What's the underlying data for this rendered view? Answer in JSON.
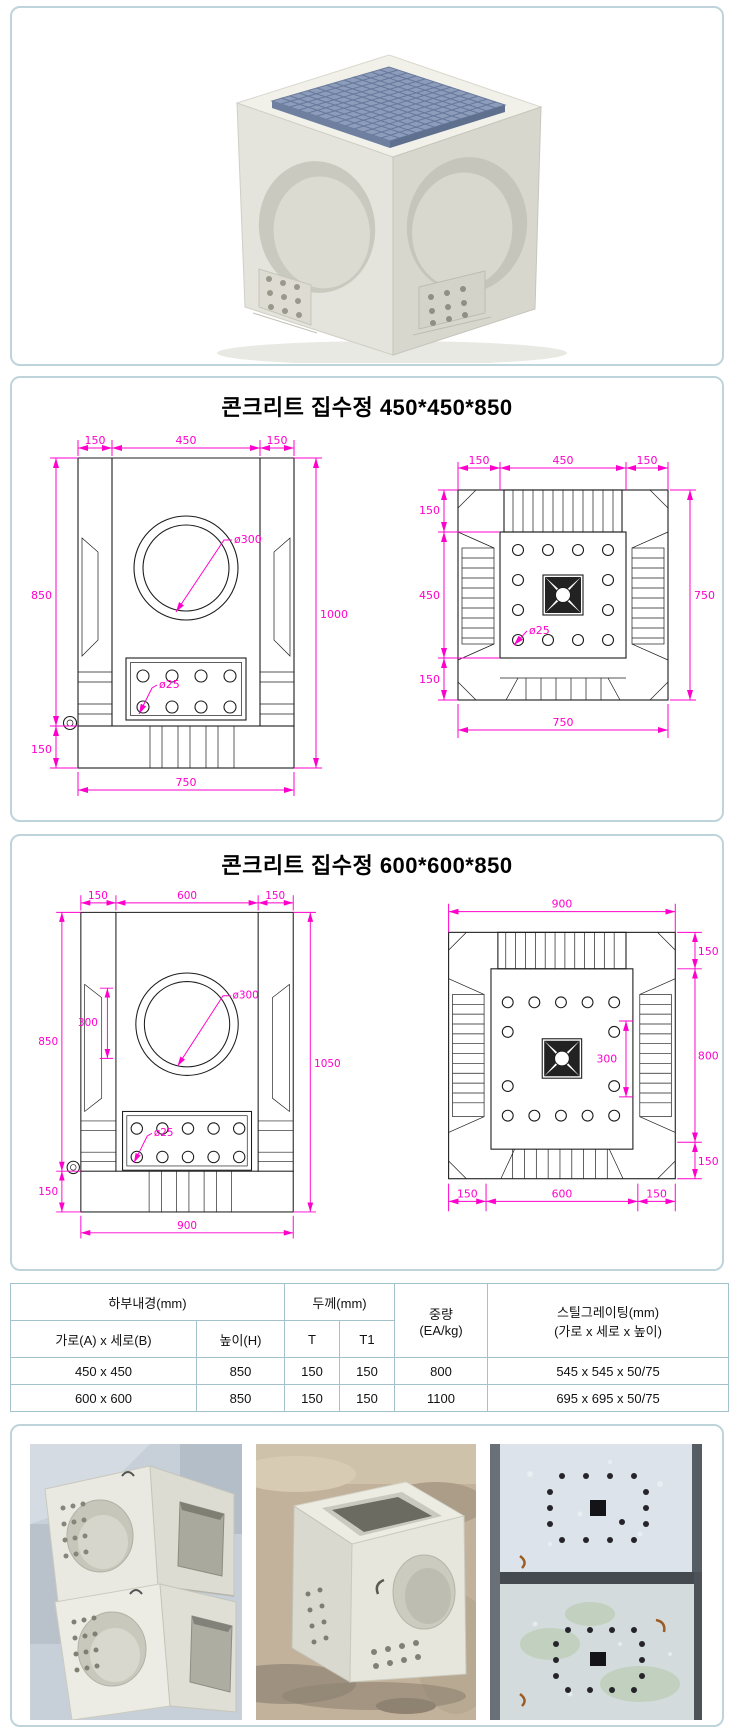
{
  "page": {
    "panel_border": "#bfd4da",
    "dim_color": "#ff00cc",
    "line_color": "#1c1c1c",
    "grating_color": "#8c9cba"
  },
  "hero": {
    "name": "concrete-catch-basin-3d-render"
  },
  "sections": {
    "d450": {
      "title": "콘크리트 집수정 450*450*850",
      "front": {
        "top": [
          "150",
          "450",
          "150"
        ],
        "left": "850",
        "left_bottom": "150",
        "right": "1000",
        "dia": "ø300",
        "hole": "ø25",
        "bottom": "750"
      },
      "plan": {
        "top": [
          "150",
          "450",
          "150"
        ],
        "left": [
          "150",
          "450",
          "150"
        ],
        "right": "750",
        "bottom": "750",
        "hole": "ø25"
      }
    },
    "d600": {
      "title": "콘크리트 집수정 600*600*850",
      "front": {
        "top": [
          "150",
          "600",
          "150"
        ],
        "left": "850",
        "left_inner": "300",
        "left_bottom": "150",
        "right": "1050",
        "dia": "ø300",
        "hole": "ø25",
        "bottom": "900"
      },
      "plan": {
        "top": "900",
        "right": [
          "150",
          "800",
          "150"
        ],
        "inner": "300",
        "bottom": [
          "150",
          "600",
          "150"
        ]
      }
    }
  },
  "table": {
    "headers": {
      "inner": "하부내경(mm)",
      "thickness": "두께(mm)",
      "weight1": "중량",
      "weight2": "(EA/kg)",
      "grating1": "스틸그레이팅(mm)",
      "grating2": "(가로 x 세로 x 높이)",
      "size": "가로(A) x 세로(B)",
      "height": "높이(H)",
      "t": "T",
      "t1": "T1"
    },
    "rows": [
      {
        "size": "450 x 450",
        "height": "850",
        "t": "150",
        "t1": "150",
        "weight": "800",
        "grating": "545 x 545 x 50/75"
      },
      {
        "size": "600 x 600",
        "height": "850",
        "t": "150",
        "t1": "150",
        "weight": "1100",
        "grating": "695 x 695 x 50/75"
      }
    ]
  },
  "photos": [
    {
      "name": "stacked-catch-basins-photo"
    },
    {
      "name": "catch-basin-top-opening-photo"
    },
    {
      "name": "catch-basin-drain-holes-photo"
    }
  ]
}
